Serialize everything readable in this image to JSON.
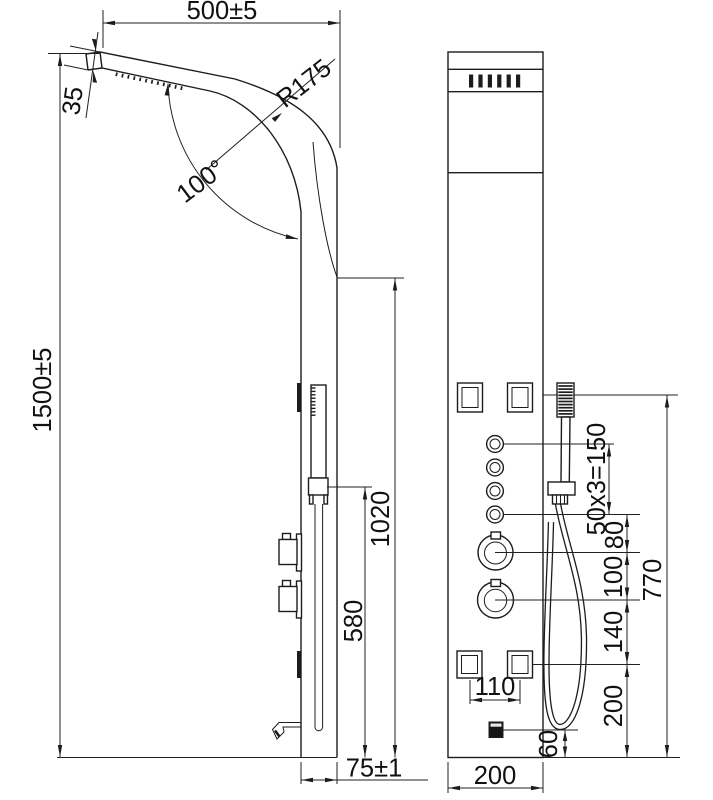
{
  "drawing": {
    "title": "shower panel dimensional drawing",
    "type": "two-view technical line drawing",
    "colors": {
      "line": "#1c1c1c",
      "background": "#ffffff",
      "text": "#111111"
    },
    "side_view": {
      "dims": {
        "top_width": "500±5",
        "head_thickness": "35",
        "bend_radius": "R175",
        "bend_angle": "100°",
        "total_height": "1500±5",
        "panel_height": "1020",
        "handshower_height": "580",
        "base_depth": "75±1"
      }
    },
    "front_view": {
      "dims": {
        "button_spacing": "50x3=150",
        "button_to_knob": "80",
        "knob_spacing": "100",
        "knob_to_jet": "140",
        "jet_to_bottom": "200",
        "handshower_drop": "770",
        "jet_spacing": "110",
        "outlet_height": "60",
        "panel_width": "200"
      }
    }
  }
}
